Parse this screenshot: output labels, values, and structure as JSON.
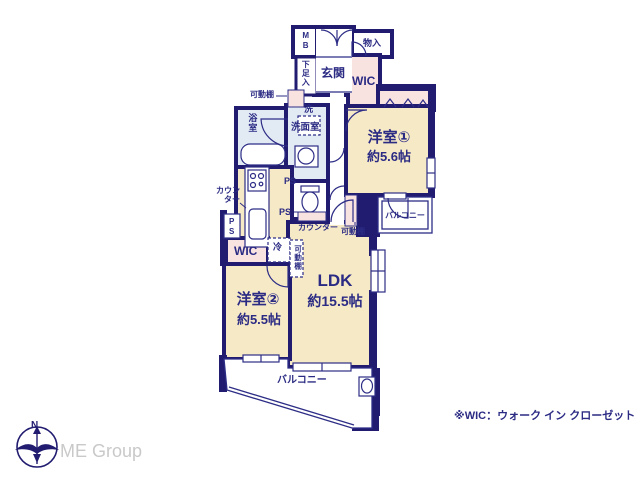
{
  "colors": {
    "wall": "#211c70",
    "line": "#2d2d86",
    "room_cream": "#f6e9c6",
    "closet_pink": "#f9e3e1",
    "wet_blue": "#e2ebf4",
    "text_navy": "#2b2b84",
    "brand_gray": "#c9c9c9"
  },
  "rooms": {
    "ldk": {
      "name": "LDK",
      "size": "約15.5帖"
    },
    "bedroom1": {
      "name": "洋室①",
      "size": "約5.6帖"
    },
    "bedroom2": {
      "name": "洋室②",
      "size": "約5.5帖"
    },
    "entrance": {
      "label": "玄関"
    },
    "bathroom": {
      "label": "浴室"
    },
    "washroom": {
      "label": "洗面室"
    },
    "wic_upper": {
      "label": "WIC"
    },
    "wic_lower": {
      "label": "WIC"
    },
    "balcony_upper": {
      "label": "バルコニー"
    },
    "balcony_lower": {
      "label": "バルコニー"
    }
  },
  "labels": {
    "meter_box": "MB",
    "storage": "物入",
    "shoe_box": "下足入",
    "movable_shelf": "可動棚",
    "washer": "洗",
    "pipe_space": "PS",
    "counter": "カウンター",
    "counter_wrapped": "カウン\nター",
    "fridge": "冷"
  },
  "footer": {
    "wic_note": "※WIC：ウォーク イン クローゼット",
    "brand": "ME Group",
    "compass_north": "N"
  }
}
